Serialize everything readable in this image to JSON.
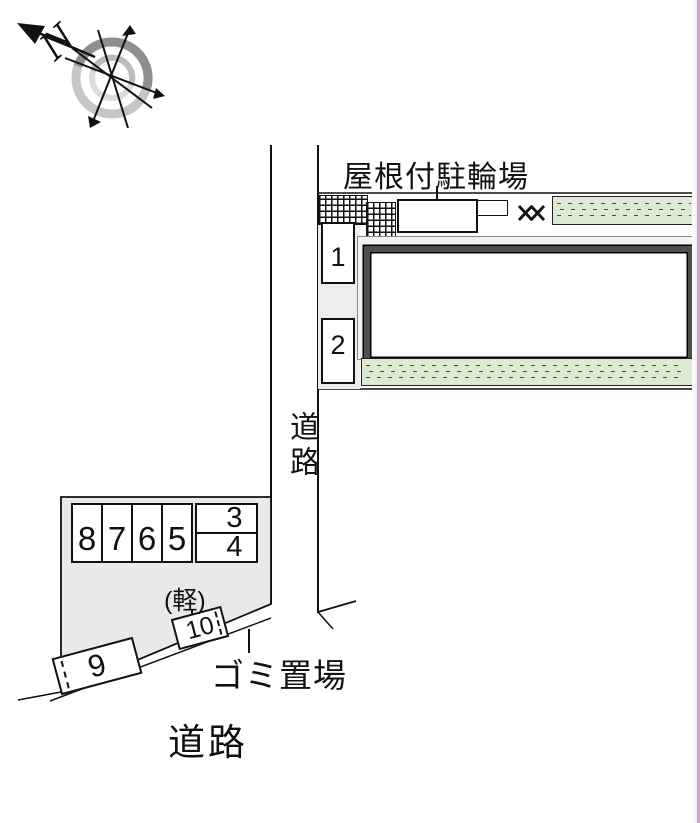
{
  "compass": {
    "north_label": "N"
  },
  "site": {
    "covered_bicycle_parking_label": "屋根付駐輪場",
    "road_side_label": "道路",
    "road_bottom_label": "道路",
    "garbage_place_label": "ゴミ置場",
    "light_vehicle_label": "(軽)"
  },
  "parking_spaces": {
    "s1": "1",
    "s2": "2",
    "s3": "3",
    "s4": "4",
    "s5": "5",
    "s6": "6",
    "s7": "7",
    "s8": "8",
    "s9": "9",
    "s10": "10"
  },
  "colors": {
    "planting_green": "#dcead2",
    "lot_gray": "#e9e9e9",
    "building_frame_gray": "#4f4f4f",
    "right_edge_pink": "#cfa3ca"
  }
}
